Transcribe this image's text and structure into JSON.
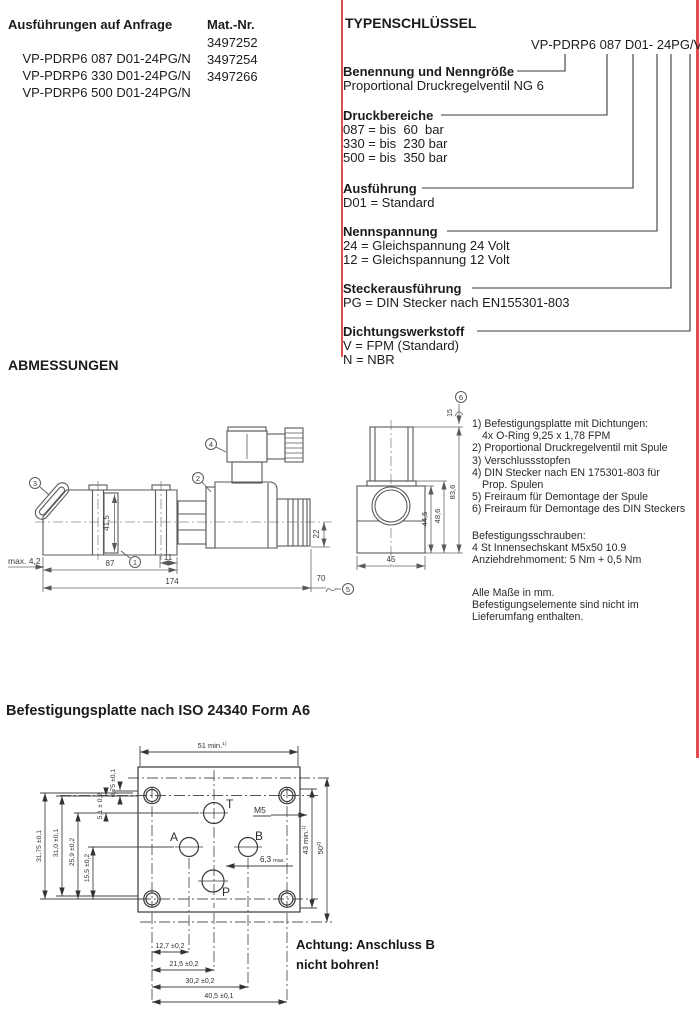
{
  "requests": {
    "title": "Ausführungen auf Anfrage",
    "col_mat": "Mat.-Nr.",
    "rows": [
      {
        "type": "VP-PDRP6 087 D01-24PG/N",
        "mat": "3497252"
      },
      {
        "type": "VP-PDRP6 330 D01-24PG/N",
        "mat": "3497254"
      },
      {
        "type": "VP-PDRP6 500 D01-24PG/N",
        "mat": "3497266"
      }
    ]
  },
  "typekey": {
    "title": "TYPENSCHLÜSSEL",
    "code": "VP-PDRP6 087 D01- 24PG/V",
    "sections": [
      {
        "heading": "Benennung und Nenngröße",
        "lines": [
          "Proportional Druckregelventil NG 6"
        ]
      },
      {
        "heading": "Druckbereiche",
        "lines": [
          "087 = bis  60  bar",
          "330 = bis  230 bar",
          "500 = bis  350 bar"
        ]
      },
      {
        "heading": "Ausführung",
        "lines": [
          "D01 = Standard"
        ]
      },
      {
        "heading": "Nennspannung",
        "lines": [
          "24 = Gleichspannung 24 Volt",
          "12 = Gleichspannung 12 Volt"
        ]
      },
      {
        "heading": "Steckerausführung",
        "lines": [
          "PG = DIN Stecker nach EN155301-803"
        ]
      },
      {
        "heading": "Dichtungswerkstoff",
        "lines": [
          "V = FPM (Standard)",
          "N = NBR"
        ]
      }
    ]
  },
  "abmessungen": {
    "title": "ABMESSUNGEN",
    "balloons": [
      "1",
      "2",
      "3",
      "4",
      "5",
      "6"
    ],
    "dims": {
      "max42": "max. 4,2",
      "d87": "87",
      "d11": "11",
      "d174": "174",
      "d70": "70",
      "d22": "22",
      "d415": "41,5",
      "d45": "45",
      "d445": "44,5",
      "d486": "48,6",
      "d836": "83,6",
      "d15": "15"
    },
    "notes": [
      "1) Befestigungsplatte mit Dichtungen:",
      "4x O-Ring 9,25 x 1,78 FPM",
      "2) Proportional Druckregelventil mit Spule",
      "3) Verschlussstopfen",
      "4) DIN Stecker nach EN 175301-803 für",
      "Prop. Spulen",
      "5) Freiraum für Demontage der Spule",
      "6) Freiraum für Demontage des DIN Steckers"
    ],
    "screws": [
      "Befestigungsschrauben:",
      "4 St Innensechskant M5x50 10.9",
      "Anziehdrehmoment: 5 Nm + 0,5 Nm"
    ],
    "footer": [
      "Alle Maße in mm.",
      "Befestigungselemente sind nicht im",
      "Lieferumfang enthalten."
    ]
  },
  "plate": {
    "title": "Befestigungsplatte nach ISO 24340 Form A6",
    "warning": [
      "Achtung: Anschluss B",
      "nicht bohren!"
    ],
    "ports": {
      "t": "T",
      "a": "A",
      "b": "B",
      "p": "P",
      "m5": "M5"
    },
    "dims": {
      "top": "51 min.",
      "top_ref": "1)",
      "right_43": "43 min.",
      "right_43_ref": "1)",
      "right_50": "50",
      "right_50_ref": "2)",
      "left": [
        "31,75 ±0,1",
        "31,0 ±0,1",
        "25,9 ±0,2",
        "15,5 ±0,2",
        "5,1 ± 0,2",
        "0,75 ±0,1"
      ],
      "bottom": [
        "12,7 ±0,2",
        "21,5 ±0,2",
        "30,2 ±0,2",
        "40,5 ±0,1"
      ],
      "d63": "6,3",
      "d63_max": "max."
    }
  },
  "colors": {
    "accent_red": "#e04f4f"
  }
}
